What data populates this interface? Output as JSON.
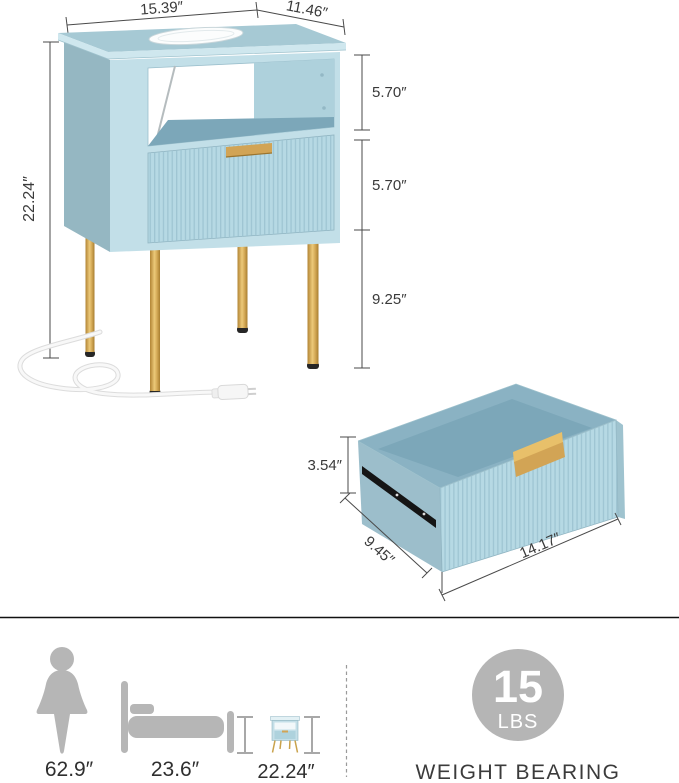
{
  "colors": {
    "top-surface": "#a6c9d4",
    "edge-band": "#cfe7ee",
    "side-panel": "#95b7c2",
    "front-frame": "#c2dfe8",
    "drawer-front": "#b6d9e4",
    "flute-line": "#9cc3d1",
    "shelf-floor": "#7ca7b9",
    "inner-wall": "#aed1dc",
    "interior": "#8ab2c3",
    "gold": "#d2a455",
    "gold-light": "#e8c06a",
    "leg-cap": "#262626",
    "dim-line": "#4a4a4a",
    "dim-text": "#3a3a3a",
    "icon-gray": "#b6b6b6",
    "badge-gray": "#b5b5b5",
    "caption-text": "#3b3b3b"
  },
  "diagram": {
    "nightstand": {
      "top_width": "15.39″",
      "top_depth": "11.46″",
      "total_height": "22.24″",
      "open_shelf_height": "5.70″",
      "drawer_height": "5.70″",
      "leg_height": "9.25″"
    },
    "drawer": {
      "height": "3.54″",
      "depth": "9.45″",
      "width": "14.17″"
    }
  },
  "scale_reference": {
    "person_height": "62.9″",
    "bed_height": "23.6″",
    "nightstand_height": "22.24″"
  },
  "weight_capacity": {
    "value": "15",
    "unit": "LBS",
    "caption": "WEIGHT BEARING"
  }
}
